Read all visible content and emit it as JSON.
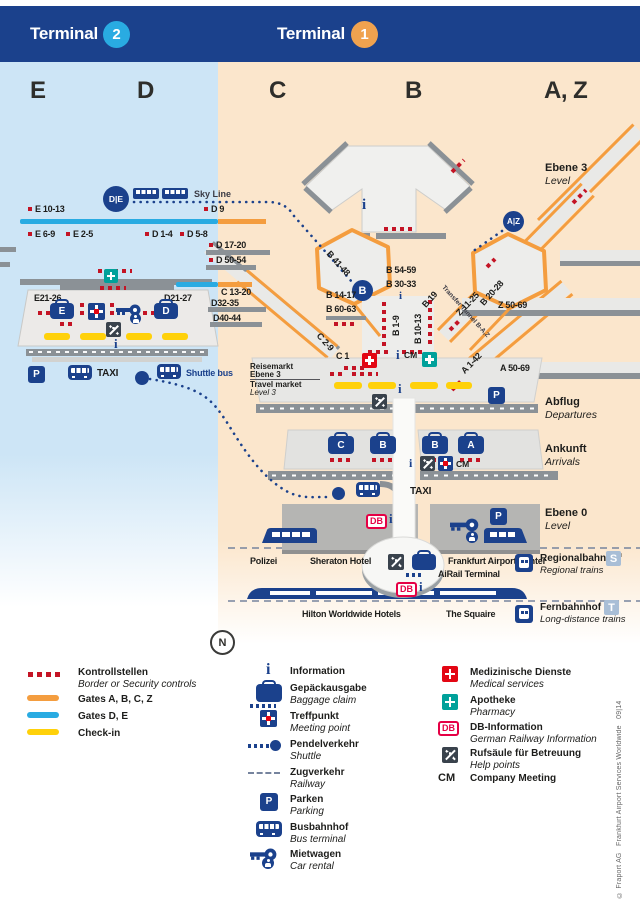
{
  "header": {
    "t2_label": "Terminal",
    "t2_num": "2",
    "t1_label": "Terminal",
    "t1_num": "1"
  },
  "sections": [
    "E",
    "D",
    "C",
    "B",
    "A, Z"
  ],
  "glyphs": {
    "p": "P",
    "i": "i",
    "db": "DB",
    "cm": "CM",
    "n": "N"
  },
  "t2": {
    "de_badge": "D|E",
    "skyline": "Sky Line",
    "taxi": "TAXI",
    "shuttle_bus": "Shuttle bus",
    "bag_e": "E",
    "bag_d": "D",
    "gates": {
      "e10": "E 10-13",
      "d9": "D 9",
      "e6": "E 6-9",
      "e2": "E 2-5",
      "d1": "D 1-4",
      "d5": "D 5-8",
      "d17": "D 17-20",
      "d50": "D 50-54",
      "e21": "E21-26",
      "d21": "D21-27",
      "c13": "C 13-20",
      "d32": "D32-35",
      "d40": "D40-44"
    }
  },
  "t1": {
    "b_badge": "B",
    "az_badge": "A|Z",
    "taxi": "TAXI",
    "transfer_tunnel": "Transfer Tunnel B-A,Z",
    "reisemarkt": {
      "de1": "Reisemarkt",
      "de2": "Ebene 3",
      "en1": "Travel market",
      "en2": "Level 3"
    },
    "bag": {
      "c": "C",
      "b1": "B",
      "b2": "B",
      "a": "A"
    },
    "gates": {
      "b41": "B 41-48",
      "b20": "B 20-28",
      "b54": "B 54-59",
      "b30": "B 30-33",
      "b19": "B 19",
      "b14": "B 14-17",
      "b60": "B 60-63",
      "b1": "B 1-9",
      "b10": "B 10-13",
      "c2": "C 2-9",
      "c1": "C 1",
      "z11": "Z 11-25",
      "z50": "Z 50-69",
      "a1": "A 1-42",
      "a50": "A 50-69"
    }
  },
  "levels": {
    "ebene3": {
      "de": "Ebene 3",
      "en": "Level"
    },
    "abflug": {
      "de": "Abflug",
      "en": "Departures"
    },
    "ankunft": {
      "de": "Ankunft",
      "en": "Arrivals"
    },
    "ebene0": {
      "de": "Ebene 0",
      "en": "Level"
    },
    "regional": {
      "de": "Regionalbahnhof",
      "en": "Regional trains",
      "badge": "S"
    },
    "fern": {
      "de": "Fernbahnhof",
      "en": "Long-distance trains",
      "badge": "T"
    }
  },
  "places": {
    "polizei": "Polizei",
    "sheraton": "Sheraton Hotel",
    "fac": "Frankfurt Airport Center",
    "airail": "AiRail Terminal",
    "hilton": "Hilton Worldwide Hotels",
    "squaire": "The Squaire"
  },
  "compass": "N",
  "legend": {
    "left": [
      {
        "de": "Kontrollstellen",
        "en": "Border or Security controls"
      },
      {
        "de": "Gates A, B, C, Z"
      },
      {
        "de": "Gates D, E"
      },
      {
        "de": "Check-in"
      }
    ],
    "center": [
      {
        "de": "Information"
      },
      {
        "de": "Gepäckausgabe",
        "en": "Baggage claim"
      },
      {
        "de": "Treffpunkt",
        "en": "Meeting point"
      },
      {
        "de": "Pendelverkehr",
        "en": "Shuttle"
      },
      {
        "de": "Zugverkehr",
        "en": "Railway"
      },
      {
        "de": "Parken",
        "en": "Parking"
      },
      {
        "de": "Busbahnhof",
        "en": "Bus terminal"
      },
      {
        "de": "Mietwagen",
        "en": "Car rental"
      }
    ],
    "right": [
      {
        "de": "Medizinische Dienste",
        "en": "Medical services"
      },
      {
        "de": "Apotheke",
        "en": "Pharmacy"
      },
      {
        "de": "DB-Information",
        "en": "German Railway Information"
      },
      {
        "de": "Rufsäule für Betreuung",
        "en": "Help points"
      },
      {
        "sym": "CM",
        "de": "Company Meeting"
      }
    ]
  },
  "copyright": "© Fraport AG   Frankfurt Airport Services Worldwide   09|14",
  "colors": {
    "navy": "#1b418c",
    "blue": "#29abe2",
    "orange": "#f49d3f",
    "peach": "#fbe6cc",
    "lightblue": "#cde5f6",
    "yellow": "#ffd10a",
    "red": "#c41425",
    "teal": "#00a19a",
    "db_red": "#e50045",
    "gray_pier": "#8b9196"
  }
}
